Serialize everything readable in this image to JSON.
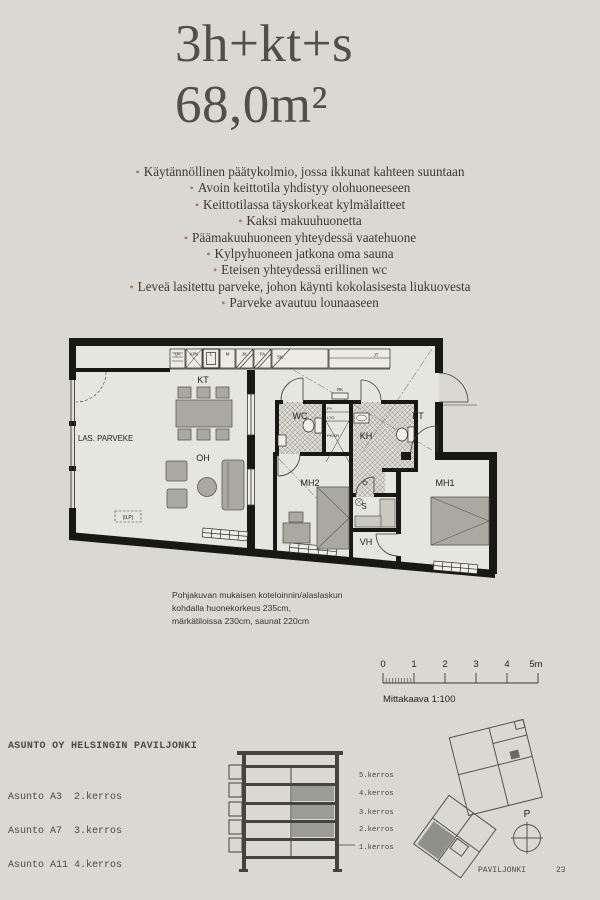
{
  "header": {
    "line1": "3h+kt+s",
    "line2": "68,0m²"
  },
  "features": [
    "Käytännöllinen päätykolmio, jossa ikkunat kahteen suuntaan",
    "Avoin keittotila yhdistyy olohuoneeseen",
    "Keittotilassa täyskorkeat kylmälaitteet",
    "Kaksi makuuhuonetta",
    "Päämakuuhuoneen yhteydessä vaatehuone",
    "Kylpyhuoneen jatkona oma sauna",
    "Eteisen yhteydessä erillinen wc",
    "Leveä lasitettu parveke, johon käynti kokolasisesta liukuovesta",
    "Parveke avautuu lounaaseen"
  ],
  "plan": {
    "balcony": "LAS. PARVEKE",
    "kt": "KT",
    "oh": "OH",
    "wc": "WC",
    "kh": "KH",
    "et": "ET",
    "mh1": "MH1",
    "mh2": "MH2",
    "s": "S",
    "vh": "VH",
    "ilp": "(ILP)",
    "rk": "RK",
    "py": "PY",
    "lto": "LTO",
    "pkkr": "PK/KR",
    "appliances": {
      "ua": "UA",
      "apk": "APK",
      "l": "L",
      "m": "M",
      "jk": "JK",
      "pa": "PA",
      "sk": "SK",
      "jt": "JT"
    }
  },
  "notes": {
    "line1": "Pohjakuvan mukaisen koteloinnin/alaslaskun",
    "line2": "kohdalla huonekorkeus 235cm,",
    "line3": "märkätiloissa 230cm, saunat 220cm"
  },
  "scalebar": {
    "t0": "0",
    "t1": "1",
    "t2": "2",
    "t3": "3",
    "t4": "4",
    "t5": "5m",
    "caption": "Mittakaava 1:100"
  },
  "project": {
    "name": "ASUNTO OY HELSINGIN PAVILJONKI",
    "units": [
      "Asunto A3  2.kerros",
      "Asunto A7  3.kerros",
      "Asunto A11 4.kerros"
    ]
  },
  "section": {
    "f5": "5.kerros",
    "f4": "4.kerros",
    "f3": "3.kerros",
    "f2": "2.kerros",
    "f1": "1.kerros"
  },
  "site": {
    "north": "P",
    "name": "PAVILJONKI",
    "page": "23"
  },
  "colors": {
    "background": "#d9d8d2",
    "bullet": "#ad7852",
    "wall": "#181814",
    "highlight_gray": "#9c9c96"
  }
}
